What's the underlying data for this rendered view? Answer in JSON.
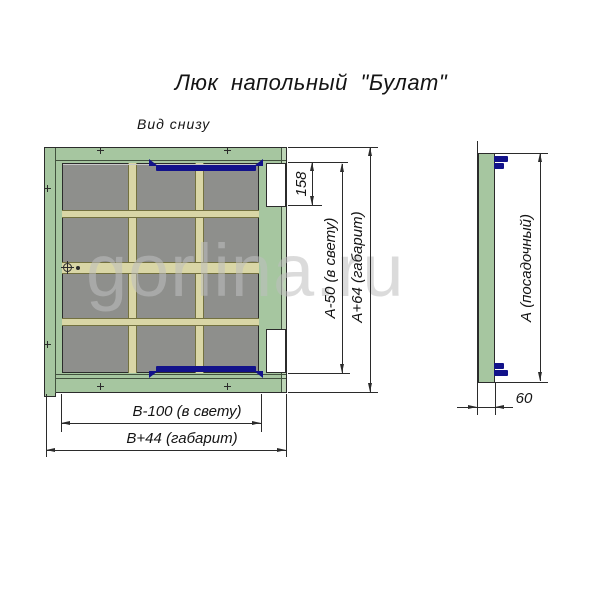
{
  "page": {
    "title": "Люк напольный \"Булат\""
  },
  "views": {
    "bottom_view": {
      "label": "Вид снизу",
      "dimensions": {
        "hinge_offset": "158",
        "height_clear": "А-50 (в свету)",
        "height_overall": "А+64 (габарит)",
        "width_clear": "В-100 (в свету)",
        "width_overall": "В+44 (габарит)"
      }
    },
    "side_view": {
      "dimensions": {
        "seat_size": "А (посадочный)",
        "depth": "60"
      }
    }
  },
  "watermark": {
    "text": "gorlina.ru"
  },
  "colors": {
    "line": "#2b2b2b",
    "frame_green": "#a6c6a0",
    "frame_green_light": "#bdd5b6",
    "panel_gray": "#8e8f8c",
    "beam_tan": "#d9d6a6",
    "beam_edge": "#73713f",
    "latch_blue": "#12128a",
    "watermark_gray": "#bfbfbf"
  }
}
